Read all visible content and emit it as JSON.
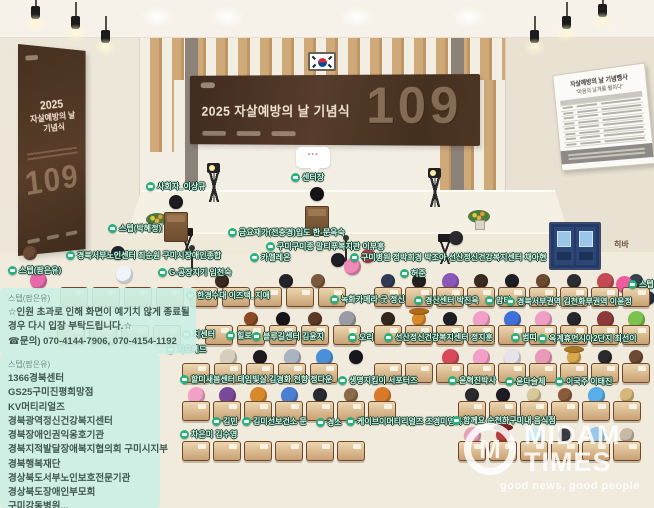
{
  "event": {
    "banner_title": "2025 자살예방의 날 기념식",
    "banner_number": "109",
    "poster_line1": "2025",
    "poster_line2": "자살예방의 날",
    "poster_line3": "기념식",
    "poster_number": "109"
  },
  "whiteboard": {
    "title": "자살예방의 날 기념행사",
    "subtitle": "\"마음의 날개를 펼치다\"",
    "row_count": 9
  },
  "speech_bubble_text": "···",
  "announcement": {
    "sender": "스텝(팜은유)",
    "lines": [
      "☆인원 초과로 인해 화면이 예기치 않게 종료될",
      "경우 다시 입장 부탁드립니다.☆",
      "☎문의) 070-4144-7906, 070-4154-1192"
    ]
  },
  "participants_list": {
    "sender": "스텝(팜은유)",
    "items": [
      "1366경북센터",
      "GS25구미진평희망점",
      "KV머티리얼즈",
      "경북광역정신건강복지센터",
      "경북장애인권익옹호기관",
      "경북지적발달장애복지협의회 구미시지부",
      "경북행복재단",
      "경상북도서부노인보호전문기관",
      "경상북도장애인부모회",
      "구미강동병원..."
    ]
  },
  "watermark": {
    "monogram": "M",
    "name_top": "MIDAM",
    "name_bottom": "TIMES",
    "tagline": "good news, good people"
  },
  "colors": {
    "banner_brown": "#4a3224",
    "label_green": "#27b27c",
    "overlay_mint": "#cbf0e6",
    "desk_tan": "#c9a173"
  },
  "labels": [
    {
      "text": "사회자_이상규",
      "x": 146,
      "y": 186
    },
    {
      "text": "센터장",
      "x": 291,
      "y": 177
    },
    {
      "text": "스텝(박혜정)",
      "x": 108,
      "y": 228
    },
    {
      "text": "금요재가(전충경)입도 한-문옥숙",
      "x": 228,
      "y": 232
    },
    {
      "text": "구미구미종 말티푸복지관 이부흥",
      "x": 266,
      "y": 246
    },
    {
      "text": "경북서부노인센터 최순원 구미시장애인종합",
      "x": 66,
      "y": 255
    },
    {
      "text": "카멜레온",
      "x": 250,
      "y": 257
    },
    {
      "text": "구미병원 정박희경 박조아 선산정신건강복지센터 채아현",
      "x": 350,
      "y": 257
    },
    {
      "text": "스텝(팜은유)",
      "x": 8,
      "y": 270
    },
    {
      "text": "G-공장지기 임천숙",
      "x": 158,
      "y": 272
    },
    {
      "text": "허준",
      "x": 400,
      "y": 273
    },
    {
      "text": "히바",
      "x": 614,
      "y": 244,
      "style": "plain"
    },
    {
      "text": "스텝",
      "x": 628,
      "y": 284
    },
    {
      "text": "한경수대 이즈택_지애",
      "x": 186,
      "y": 295
    },
    {
      "text": "녹화카메라-굿 정신",
      "x": 330,
      "y": 299
    },
    {
      "text": "경산센터 박진옥",
      "x": 414,
      "y": 300
    },
    {
      "text": "맘티",
      "x": 485,
      "y": 300
    },
    {
      "text": "경북서부권역 김천화부권역 이윤정",
      "x": 506,
      "y": 301
    },
    {
      "text": "지센터",
      "x": 182,
      "y": 334
    },
    {
      "text": "힐로",
      "x": 226,
      "y": 335
    },
    {
      "text": "블루길센터 김윤지",
      "x": 252,
      "y": 336
    },
    {
      "text": "오리",
      "x": 348,
      "y": 337
    },
    {
      "text": "선산정신건강복지센터 정지훈",
      "x": 384,
      "y": 337
    },
    {
      "text": "범띠",
      "x": 511,
      "y": 337
    },
    {
      "text": "옥계휴먼시아2단지 최선이",
      "x": 538,
      "y": 338
    },
    {
      "text": "지오메드",
      "x": 166,
      "y": 349
    },
    {
      "text": "할미새봄센터 태임빛살 김경화 천향 정다운",
      "x": 180,
      "y": 379
    },
    {
      "text": "생명지킴이 서포터즈",
      "x": 338,
      "y": 380
    },
    {
      "text": "윤혁진박사",
      "x": 448,
      "y": 380
    },
    {
      "text": "윤다슬체",
      "x": 505,
      "y": 381
    },
    {
      "text": "이국주 이태진",
      "x": 555,
      "y": 381
    },
    {
      "text": "김민",
      "x": 212,
      "y": 421
    },
    {
      "text": "김미선보건소 문",
      "x": 242,
      "y": 421
    },
    {
      "text": "경소",
      "x": 316,
      "y": 422
    },
    {
      "text": "케이브이머티리얼즈 조경미영복",
      "x": 346,
      "y": 421
    },
    {
      "text": "함께요 순천하구미내 음식점",
      "x": 452,
      "y": 420
    },
    {
      "text": "차은미 김수영",
      "x": 180,
      "y": 434
    }
  ],
  "seating": {
    "rows": [
      {
        "y": 287,
        "blocks": [
          {
            "x": 60,
            "n": 4,
            "p": 32
          },
          {
            "x": 190,
            "n": 5,
            "p": 32
          },
          {
            "x": 374,
            "n": 9,
            "p": 31
          }
        ]
      },
      {
        "y": 325,
        "blocks": [
          {
            "x": 57,
            "n": 4,
            "p": 32
          },
          {
            "x": 205,
            "n": 5,
            "p": 32
          },
          {
            "x": 374,
            "n": 9,
            "p": 31
          }
        ]
      },
      {
        "y": 363,
        "blocks": [
          {
            "x": 182,
            "n": 5,
            "p": 32
          },
          {
            "x": 374,
            "n": 9,
            "p": 31
          }
        ]
      },
      {
        "y": 401,
        "blocks": [
          {
            "x": 182,
            "n": 7,
            "p": 31
          },
          {
            "x": 458,
            "n": 6,
            "p": 31
          }
        ]
      },
      {
        "y": 441,
        "blocks": [
          {
            "x": 182,
            "n": 6,
            "p": 31
          },
          {
            "x": 458,
            "n": 6,
            "p": 31
          }
        ]
      }
    ]
  },
  "avatars": [
    {
      "x": 222,
      "y": 285,
      "c": "#3a2a20"
    },
    {
      "x": 286,
      "y": 285,
      "c": "#23232b"
    },
    {
      "x": 318,
      "y": 285,
      "c": "#7a5a3a"
    },
    {
      "x": 388,
      "y": 285,
      "c": "#2f3b55"
    },
    {
      "x": 419,
      "y": 285,
      "c": "#231f1f"
    },
    {
      "x": 450,
      "y": 285,
      "c": "#8a57b8",
      "s": "ball"
    },
    {
      "x": 481,
      "y": 285,
      "c": "#3a2b22"
    },
    {
      "x": 512,
      "y": 285,
      "c": "#1e1e24"
    },
    {
      "x": 543,
      "y": 285,
      "c": "#6b4a2f"
    },
    {
      "x": 574,
      "y": 285,
      "c": "#2c2c34"
    },
    {
      "x": 605,
      "y": 285,
      "c": "#c44b56",
      "s": "ball"
    },
    {
      "x": 636,
      "y": 285,
      "c": "#35424f"
    },
    {
      "x": 251,
      "y": 323,
      "c": "#8a4a24"
    },
    {
      "x": 283,
      "y": 323,
      "c": "#16161c"
    },
    {
      "x": 315,
      "y": 323,
      "c": "#5b3b28"
    },
    {
      "x": 347,
      "y": 323,
      "c": "#9a9aa4",
      "s": "ball"
    },
    {
      "x": 388,
      "y": 323,
      "c": "#32281e"
    },
    {
      "x": 419,
      "y": 323,
      "c": "#d98a2b",
      "hat": "#b06a18"
    },
    {
      "x": 450,
      "y": 323,
      "c": "#1f1f26"
    },
    {
      "x": 481,
      "y": 323,
      "c": "#f2a0c8",
      "s": "ball"
    },
    {
      "x": 512,
      "y": 323,
      "c": "#3f6fd8",
      "s": "ball"
    },
    {
      "x": 543,
      "y": 323,
      "c": "#ef9ec6",
      "s": "ball"
    },
    {
      "x": 574,
      "y": 323,
      "c": "#26262e"
    },
    {
      "x": 605,
      "y": 323,
      "c": "#8e3a3a",
      "s": "ball"
    },
    {
      "x": 636,
      "y": 323,
      "c": "#7cc24e",
      "s": "ball"
    },
    {
      "x": 228,
      "y": 361,
      "c": "#d8cebe",
      "s": "ball"
    },
    {
      "x": 260,
      "y": 361,
      "c": "#1c1c20"
    },
    {
      "x": 292,
      "y": 361,
      "c": "#aab4c0",
      "s": "ball"
    },
    {
      "x": 324,
      "y": 361,
      "c": "#4a90d8",
      "s": "ball"
    },
    {
      "x": 356,
      "y": 361,
      "c": "#16161c"
    },
    {
      "x": 450,
      "y": 361,
      "c": "#d84a5a",
      "s": "ball"
    },
    {
      "x": 481,
      "y": 361,
      "c": "#f2a0c8",
      "s": "ball"
    },
    {
      "x": 512,
      "y": 361,
      "c": "#e8e2ea",
      "s": "ball"
    },
    {
      "x": 543,
      "y": 361,
      "c": "#e89ab8",
      "s": "ball"
    },
    {
      "x": 574,
      "y": 361,
      "c": "#d8a84a",
      "hat": "#a87828"
    },
    {
      "x": 605,
      "y": 361,
      "c": "#2a2a2e"
    },
    {
      "x": 636,
      "y": 361,
      "c": "#6b4a2f"
    },
    {
      "x": 196,
      "y": 399,
      "c": "#f2a0c8",
      "s": "ball"
    },
    {
      "x": 227,
      "y": 399,
      "c": "#7a4a9a",
      "s": "ball"
    },
    {
      "x": 258,
      "y": 399,
      "c": "#d88a2a",
      "s": "ball"
    },
    {
      "x": 289,
      "y": 399,
      "c": "#4a7fd4",
      "s": "ball"
    },
    {
      "x": 320,
      "y": 399,
      "c": "#2a2a32"
    },
    {
      "x": 351,
      "y": 399,
      "c": "#8a6a4a"
    },
    {
      "x": 382,
      "y": 399,
      "c": "#d87a2a",
      "s": "ball"
    },
    {
      "x": 472,
      "y": 399,
      "c": "#2a2a2e"
    },
    {
      "x": 503,
      "y": 399,
      "c": "#1c1c22"
    },
    {
      "x": 534,
      "y": 399,
      "c": "#d8c89a"
    },
    {
      "x": 565,
      "y": 399,
      "c": "#8a5a3a"
    },
    {
      "x": 596,
      "y": 399,
      "c": "#58aee8",
      "s": "ball"
    },
    {
      "x": 627,
      "y": 399,
      "c": "#d8b87a"
    },
    {
      "x": 472,
      "y": 439,
      "c": "#e8a0b8",
      "s": "ball"
    },
    {
      "x": 503,
      "y": 439,
      "c": "#b83a3a",
      "hat": "#7a2020"
    },
    {
      "x": 534,
      "y": 439,
      "c": "#cfe8f2",
      "s": "ball"
    },
    {
      "x": 565,
      "y": 439,
      "c": "#3a3a42"
    },
    {
      "x": 596,
      "y": 439,
      "c": "#9ac8e8",
      "s": "ball"
    },
    {
      "x": 627,
      "y": 439,
      "c": "#c8b8a8"
    },
    {
      "x": 38,
      "y": 284,
      "c": "#e86aa8",
      "s": "ball"
    },
    {
      "x": 124,
      "y": 278,
      "c": "#eef4fa",
      "s": "ball"
    },
    {
      "x": 30,
      "y": 257,
      "c": "#6a4a32"
    },
    {
      "x": 118,
      "y": 257,
      "c": "#23232b"
    },
    {
      "x": 338,
      "y": 264,
      "c": "#1e1e26"
    },
    {
      "x": 352,
      "y": 270,
      "c": "#f08ab8",
      "s": "ball"
    },
    {
      "x": 368,
      "y": 260,
      "c": "#c43b4a"
    },
    {
      "x": 624,
      "y": 288,
      "c": "#f05aa0",
      "s": "ball"
    },
    {
      "x": 648,
      "y": 302,
      "c": "#2e2e38"
    },
    {
      "x": 456,
      "y": 242,
      "c": "#2a2a30"
    },
    {
      "x": 176,
      "y": 206,
      "c": "#1c1c22"
    },
    {
      "x": 317,
      "y": 198,
      "c": "#141418"
    }
  ]
}
